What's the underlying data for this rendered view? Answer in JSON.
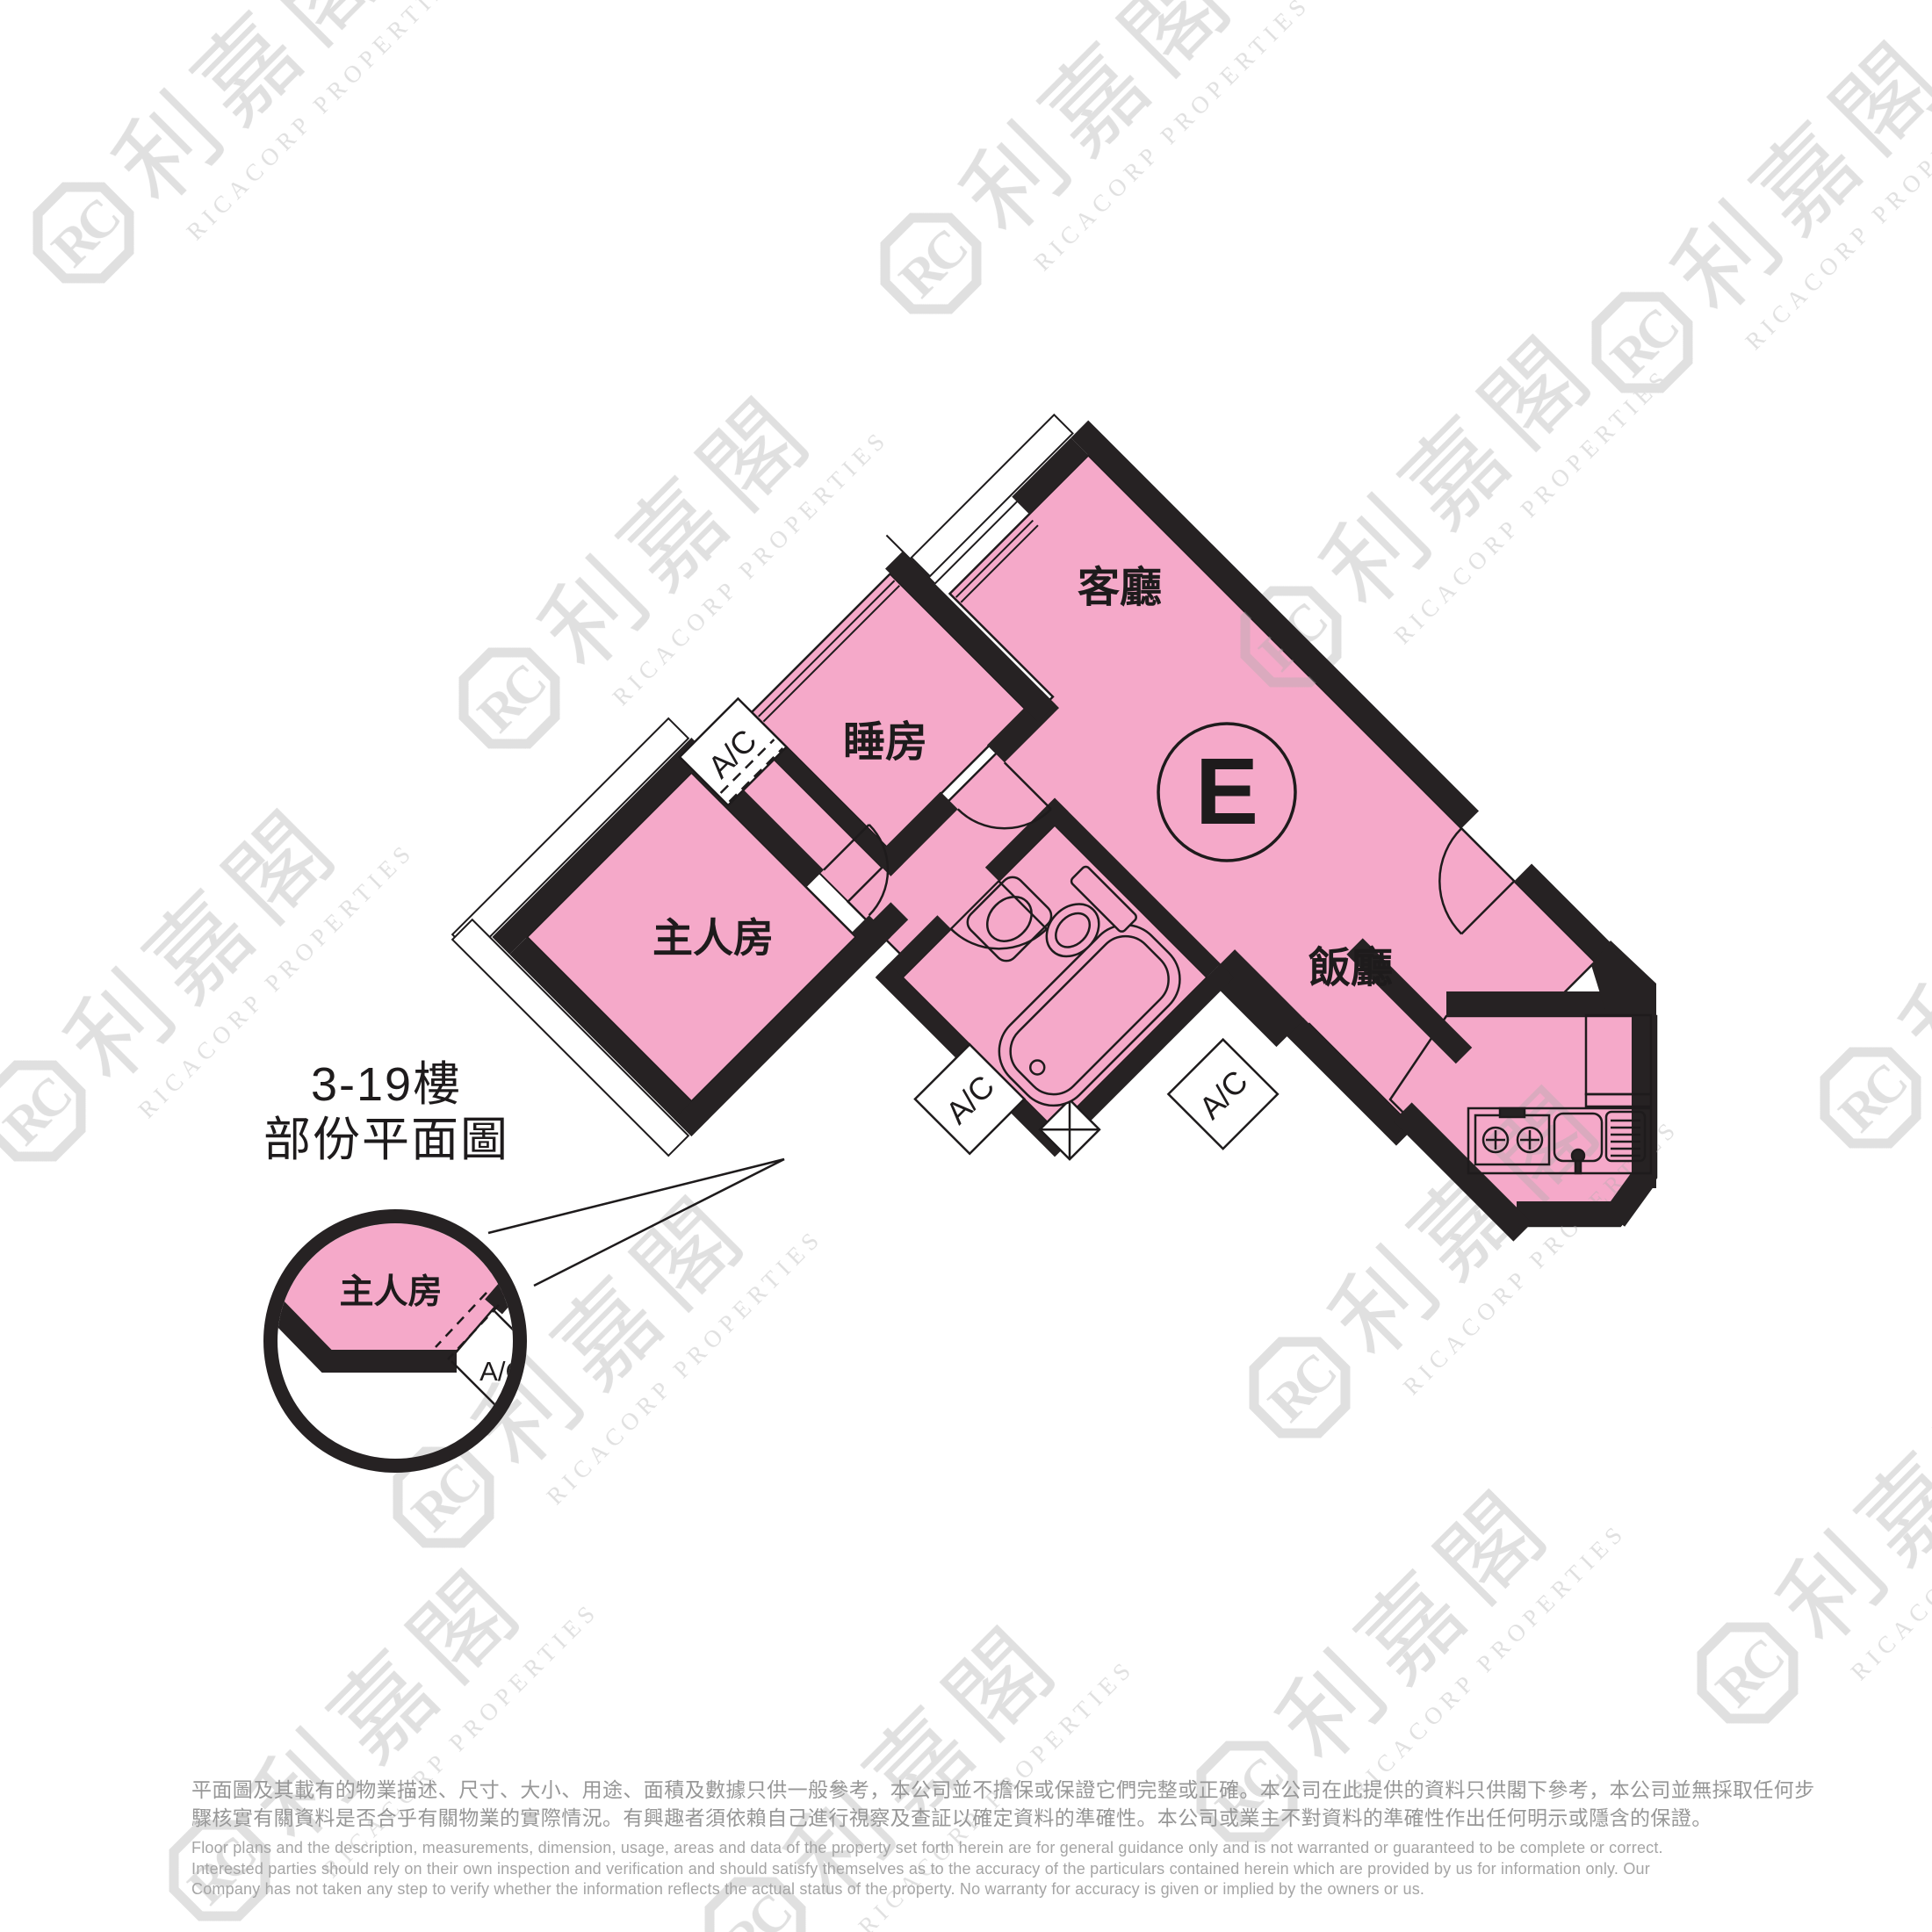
{
  "title": {
    "line1": "3-19樓",
    "line2": "部份平面圖"
  },
  "plan": {
    "unit_label": "E",
    "room_labels": {
      "living": "客廳",
      "bedroom": "睡房",
      "master": "主人房",
      "dining": "飯廳"
    },
    "ac_label": "A/C",
    "detail": {
      "room": "主人房",
      "ac": "A/C"
    }
  },
  "watermark": {
    "monogram": "RC",
    "chinese": "利嘉閣",
    "english": "RICACORP PROPERTIES"
  },
  "disclaimer": {
    "chinese": [
      "平面圖及其載有的物業描述、尺寸、大小、用途、面積及數據只供一般參考，本公司並不擔保或保證它們完整或正確。本公司在此提供的資料只供閣下參考，本公司並無採取任何步",
      "驟核實有關資料是否合乎有關物業的實際情況。有興趣者須依賴自己進行視察及查証以確定資料的準確性。本公司或業主不對資料的準確性作出任何明示或隱含的保證。"
    ],
    "english": [
      "Floor plans and the description, measurements, dimension, usage, areas and data of the property set forth herein are for general guidance only and is not warranted or guaranteed to be complete or correct.",
      "Interested parties should rely on their own inspection and verification and should satisfy themselves as to the accuracy of the particulars contained herein which are provided by us for information only.  Our",
      "Company has not taken any step to verify whether the information reflects the actual status of the property.  No warranty for accuracy is given or implied by the owners or us."
    ]
  },
  "colors": {
    "room_fill_pink": "#F5A9C9",
    "wall_black": "#262223",
    "watermark_gray": "#ADADAD",
    "disclaimer_gray": "#979797"
  }
}
